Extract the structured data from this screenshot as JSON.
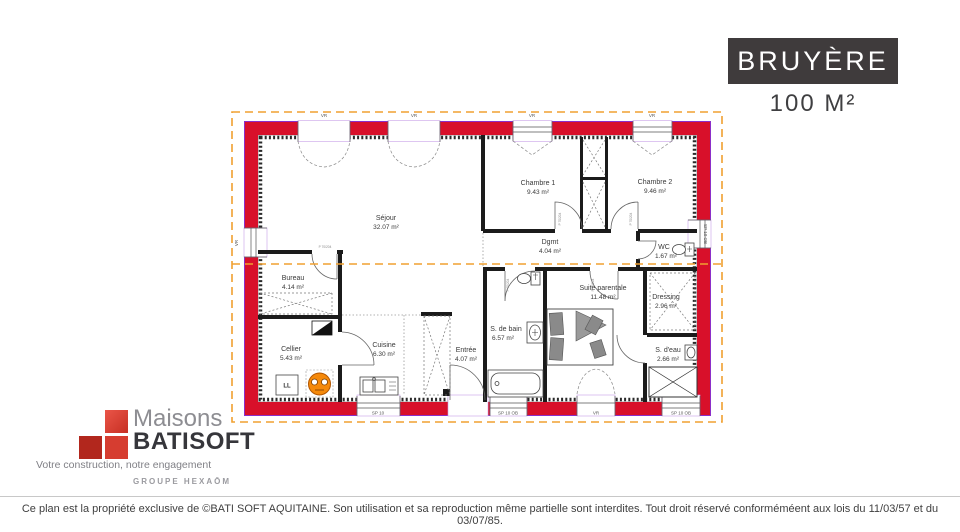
{
  "title_block": {
    "name": "BRUYÈRE",
    "area": "100 M²"
  },
  "plan": {
    "rooms": [
      {
        "name": "Séjour",
        "area": "32.07 m²"
      },
      {
        "name": "Chambre 1",
        "area": "9.43 m²"
      },
      {
        "name": "Chambre 2",
        "area": "9.46 m²"
      },
      {
        "name": "Dgmt",
        "area": "4.04 m²"
      },
      {
        "name": "WC",
        "area": "1.67 m²"
      },
      {
        "name": "Bureau",
        "area": "4.14 m²"
      },
      {
        "name": "Cellier",
        "area": "5.43 m²"
      },
      {
        "name": "Cuisine",
        "area": "6.30 m²"
      },
      {
        "name": "Entrée",
        "area": "4.07 m²"
      },
      {
        "name": "S. de bain",
        "area": "6.57 m²"
      },
      {
        "name": "Suite parentale",
        "area": "11.48 m²"
      },
      {
        "name": "Dressing",
        "area": "2.96 m²"
      },
      {
        "name": "S. d'eau",
        "area": "2.66 m²"
      }
    ],
    "openings": {
      "vr": "VR",
      "sp10": "SP 10",
      "sp10ob": "SP 10 OB"
    },
    "door_label": "P 70/204",
    "appliance_label": "LL",
    "colors": {
      "wall": "#d8102a",
      "wall_outline": "#8b2fc9",
      "roof_dashed": "#f0a030",
      "water_heater": "#f5890a",
      "title_box": "#3f3b3c",
      "logo_red_dark": "#b2271d",
      "logo_red_mid": "#d63d30",
      "logo_red_light": "#ea5548"
    }
  },
  "logo": {
    "line1": "Maisons",
    "line2": "BATISOFT",
    "tagline": "Votre construction, notre engagement",
    "group": "GROUPE HEXAŌM"
  },
  "footer": {
    "text": "Ce plan est la propriété exclusive de ©BATI SOFT AQUITAINE. Son utilisation et sa reproduction même partielle sont interdites. Tout droit réservé conforméméent aux lois du 11/03/57 et du 03/07/85."
  }
}
